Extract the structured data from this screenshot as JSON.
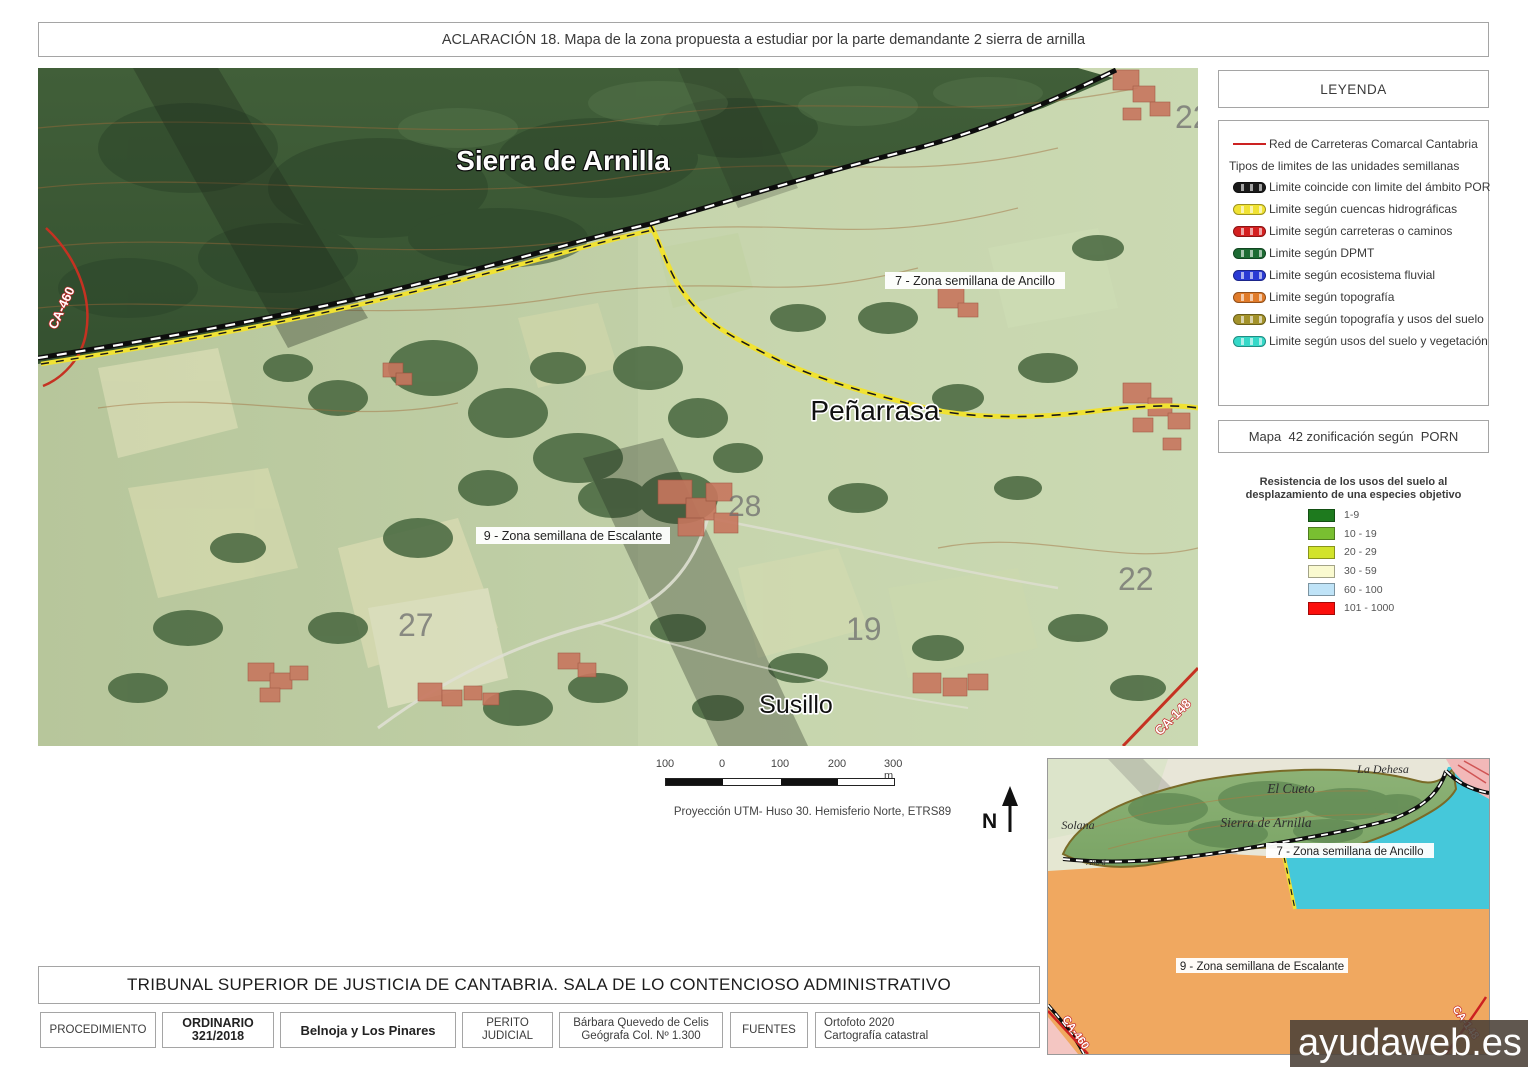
{
  "page": {
    "title": "ACLARACIÓN 18. Mapa de la zona propuesta a estudiar por la parte demandante 2 sierra de arnilla"
  },
  "legend": {
    "title": "LEYENDA",
    "road_entry": {
      "label": "Red de Carreteras Comarcal Cantabria",
      "color": "#cc2222"
    },
    "subtitle": "Tipos de limites de las unidades semillanas",
    "items": [
      {
        "label": "Limite coincide con limite del ámbito POR",
        "color": "#1a1a1a"
      },
      {
        "label": "Limite según cuencas hidrográficas",
        "color": "#f0e233"
      },
      {
        "label": "Limite según carreteras o caminos",
        "color": "#d42020"
      },
      {
        "label": "Limite según DPMT",
        "color": "#1d6b33"
      },
      {
        "label": "Limite según ecosistema fluvial",
        "color": "#2a3ad4"
      },
      {
        "label": "Limite según topografía",
        "color": "#e07b2a"
      },
      {
        "label": "Limite según topografía y usos del suelo",
        "color": "#a3922a"
      },
      {
        "label": "Limite según usos del suelo y vegetación",
        "color": "#35d8c8"
      }
    ],
    "map42_title": "Mapa  42 zonificación según  PORN",
    "resistance": {
      "title_line1": "Resistencia de los usos del suelo al",
      "title_line2": "desplazamiento de una especies objetivo",
      "classes": [
        {
          "label": "1-9",
          "color": "#1e7a1e"
        },
        {
          "label": "10 - 19",
          "color": "#79bf31"
        },
        {
          "label": "20 - 29",
          "color": "#d2e32b"
        },
        {
          "label": "30 - 59",
          "color": "#fafad0"
        },
        {
          "label": "60 - 100",
          "color": "#bfe3f7"
        },
        {
          "label": "101 - 1000",
          "color": "#fb0f0c"
        }
      ]
    }
  },
  "map": {
    "labels": {
      "sierra": "Sierra de Arnilla",
      "zona7": "7 - Zona semillana de Ancillo",
      "penarrasa": "Peñarrasa",
      "zona9": "9 - Zona semillana de Escalante",
      "susillo": "Susillo",
      "road_ca460": "CA-460",
      "road_ca148": "CA-148",
      "parcel_22a": "22",
      "parcel_22b": "22",
      "parcel_27": "27",
      "parcel_19": "19",
      "parcel_28": "28"
    }
  },
  "scalebar": {
    "ticks": [
      "100",
      "0",
      "100",
      "200",
      "300 m"
    ],
    "projection": "Proyección UTM- Huso 30. Hemisferio Norte, ETRS89",
    "north_label": "N"
  },
  "inset": {
    "labels": {
      "la_dehesa": "La Dehesa",
      "el_cueto": "El Cueto",
      "sierra": "Sierra de Arnilla",
      "solana": "Solana",
      "alto": "Alto d",
      "zona7": "7 - Zona semillana de Ancillo",
      "zona9": "9 - Zona semillana de Escalante",
      "ca460": "CA-460",
      "ca148": "CA-148"
    }
  },
  "watermark": "ayudaweb.es",
  "footer": {
    "court": "TRIBUNAL SUPERIOR DE JUSTICIA DE CANTABRIA. SALA DE LO CONTENCIOSO ADMINISTRATIVO",
    "cells": {
      "procedimiento_label": "PROCEDIMIENTO",
      "procedimiento_value_line1": "ORDINARIO",
      "procedimiento_value_line2": "321/2018",
      "case_name": "Belnoja y Los Pinares",
      "perito_label_line1": "PERITO",
      "perito_label_line2": "JUDICIAL",
      "perito_name_line1": "Bárbara Quevedo de Celis",
      "perito_name_line2": "Geógrafa Col. Nº 1.300",
      "fuentes_label": "FUENTES",
      "fuentes_value_line1": "Ortofoto 2020",
      "fuentes_value_line2": "Cartografía catastral"
    }
  }
}
